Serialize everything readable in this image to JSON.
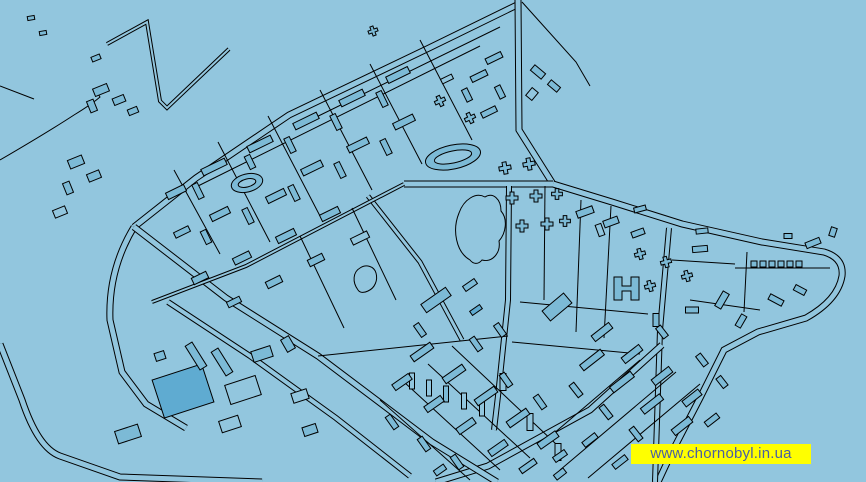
{
  "watermark": {
    "text": "www.chornobyl.in.ua",
    "background_color": "#FFFF00",
    "text_color": "#4A5FA3"
  },
  "map": {
    "colors": {
      "background": "#92C6DE",
      "building": "#7CBAD6",
      "building_dark": "#5FABD1",
      "line": "#000000"
    },
    "roads": [
      {
        "d": "M 517,5 L 429,48 L 289,115 L 196,178 L 134,227",
        "w": 7
      },
      {
        "d": "M 518,0 L 519,130 L 553,184",
        "w": 7
      },
      {
        "d": "M 553,184 L 612,202 L 682,224 L 762,242 L 824,252 Q 844,258 842,276 Q 838,300 806,318 L 758,332 L 724,350 L 700,398 L 672,452 L 658,482",
        "w": 7
      },
      {
        "d": "M 404,184 L 553,184",
        "w": 7
      },
      {
        "d": "M 509,186 L 508,300 L 498,396 L 494,430",
        "w": 6
      },
      {
        "d": "M 669,228 L 660,330 L 655,482",
        "w": 6
      },
      {
        "d": "M 662,345 L 590,410 L 488,466 L 436,482",
        "w": 7
      },
      {
        "d": "M 134,227 Q 108,270 110,320 L 122,372 L 146,404 L 186,428",
        "w": 7
      },
      {
        "d": "M 0,344 L 22,400 Q 38,448 60,456 L 120,477 L 262,482",
        "w": 7
      },
      {
        "d": "M 134,227 L 226,298 L 318,356 L 432,442 L 497,482",
        "w": 7
      },
      {
        "d": "M 168,302 L 250,356 L 336,418 L 410,476",
        "w": 6
      },
      {
        "d": "M 368,196 L 420,262 L 462,340",
        "w": 5
      },
      {
        "d": "M 107,44 L 147,22 L 160,101 L 167,108 L 229,49",
        "w": 4
      },
      {
        "d": "M 404,184 L 246,266 L 152,302",
        "w": 4
      },
      {
        "d": "M 0,160 Q 48,132 74,115 Q 92,104 100,97 L 95,89",
        "w": 1
      },
      {
        "d": "M 0,86 L 34,99",
        "w": 1
      },
      {
        "d": "M 500,27 L 298,126",
        "w": 1
      },
      {
        "d": "M 480,46 L 196,187",
        "w": 1
      },
      {
        "d": "M 420,40 L 472,140",
        "w": 1
      },
      {
        "d": "M 370,64 L 422,164",
        "w": 1
      },
      {
        "d": "M 320,90 L 372,190",
        "w": 1
      },
      {
        "d": "M 268,116 L 320,216",
        "w": 1
      },
      {
        "d": "M 218,142 L 270,242",
        "w": 1
      },
      {
        "d": "M 174,170 L 220,254",
        "w": 1
      },
      {
        "d": "M 352,208 L 396,300",
        "w": 1
      },
      {
        "d": "M 300,236 L 344,328",
        "w": 1
      },
      {
        "d": "M 545,186 L 544,300",
        "w": 1
      },
      {
        "d": "M 581,200 L 576,332",
        "w": 1
      },
      {
        "d": "M 611,206 L 604,338",
        "w": 1
      },
      {
        "d": "M 520,302 L 648,314",
        "w": 1
      },
      {
        "d": "M 512,342 L 640,354",
        "w": 1
      },
      {
        "d": "M 735,268 L 830,268",
        "w": 1
      },
      {
        "d": "M 747,252 L 744,312",
        "w": 1
      },
      {
        "d": "M 672,260 L 735,264",
        "w": 1
      },
      {
        "d": "M 690,300 L 760,310",
        "w": 1
      },
      {
        "d": "M 560,470 L 676,372",
        "w": 1
      },
      {
        "d": "M 588,478 L 700,384",
        "w": 1
      },
      {
        "d": "M 546,440 L 640,360",
        "w": 1
      },
      {
        "d": "M 380,400 L 470,480",
        "w": 1
      },
      {
        "d": "M 404,382 L 500,470",
        "w": 1
      },
      {
        "d": "M 428,364 L 530,458",
        "w": 1
      },
      {
        "d": "M 452,346 L 556,444",
        "w": 1
      },
      {
        "d": "M 318,356 L 508,336",
        "w": 1
      },
      {
        "d": "M 522,2 L 576,62 L 590,86",
        "w": 1
      }
    ],
    "organic": [
      {
        "d": "M 470,260 C 456,252 452,230 459,213 C 464,199 476,192 485,197 C 493,192 501,199 501,211 C 508,219 506,233 499,241 C 501,253 492,263 482,260 C 478,265 473,264 470,260 Z",
        "f": 0
      },
      {
        "d": "M 358,290 C 352,282 353,272 360,268 C 366,264 374,266 376,273 C 378,280 375,288 368,291 C 364,293 360,293 358,290 Z",
        "f": 0
      },
      {
        "d": "M 614,277 l 8,0 0,9 9,0 0,-9 8,0 0,23 -8,0 0,-9 -9,0 0,9 -8,0 z",
        "f": 1
      }
    ],
    "stadiums": [
      {
        "x": 453,
        "y": 157,
        "rx": 28,
        "ry": 12,
        "rx2": 19,
        "ry2": 6,
        "a": -12
      },
      {
        "x": 247,
        "y": 183,
        "rx": 16,
        "ry": 9,
        "rx2": 9,
        "ry2": 4,
        "a": -14
      }
    ],
    "buildings": [
      [
        31,
        18,
        7,
        4,
        -10,
        1
      ],
      [
        43,
        33,
        7,
        4,
        -10,
        1
      ],
      [
        96,
        58,
        9,
        5,
        -22,
        1
      ],
      [
        101,
        90,
        15,
        8,
        -22,
        1
      ],
      [
        119,
        100,
        12,
        7,
        -22,
        1
      ],
      [
        92,
        106,
        7,
        12,
        -22,
        1
      ],
      [
        133,
        111,
        10,
        6,
        -22,
        1
      ],
      [
        494,
        58,
        17,
        6,
        -26,
        1
      ],
      [
        479,
        76,
        17,
        6,
        -26,
        1
      ],
      [
        500,
        92,
        6,
        13,
        -26,
        1
      ],
      [
        467,
        95,
        6,
        13,
        -26,
        1
      ],
      [
        489,
        112,
        16,
        6,
        -26,
        1
      ],
      [
        447,
        79,
        12,
        5,
        -26,
        0
      ],
      [
        398,
        75,
        24,
        7,
        -26,
        1
      ],
      [
        352,
        98,
        26,
        7,
        -26,
        1
      ],
      [
        306,
        121,
        26,
        7,
        -26,
        1
      ],
      [
        260,
        144,
        26,
        7,
        -26,
        1
      ],
      [
        214,
        167,
        26,
        7,
        -26,
        1
      ],
      [
        176,
        192,
        20,
        7,
        -26,
        1
      ],
      [
        382,
        99,
        6,
        16,
        -26,
        1
      ],
      [
        336,
        122,
        6,
        16,
        -26,
        1
      ],
      [
        290,
        145,
        6,
        16,
        -26,
        1
      ],
      [
        250,
        162,
        6,
        14,
        -26,
        1
      ],
      [
        198,
        191,
        6,
        16,
        -26,
        1
      ],
      [
        404,
        122,
        22,
        7,
        -26,
        1
      ],
      [
        358,
        145,
        22,
        7,
        -26,
        1
      ],
      [
        312,
        168,
        22,
        7,
        -26,
        1
      ],
      [
        276,
        196,
        20,
        7,
        -26,
        1
      ],
      [
        220,
        214,
        20,
        7,
        -26,
        1
      ],
      [
        182,
        232,
        16,
        6,
        -26,
        1
      ],
      [
        340,
        170,
        6,
        16,
        -26,
        1
      ],
      [
        294,
        193,
        6,
        16,
        -26,
        1
      ],
      [
        248,
        216,
        6,
        16,
        -26,
        1
      ],
      [
        206,
        237,
        6,
        14,
        -26,
        1
      ],
      [
        386,
        147,
        6,
        16,
        -26,
        1
      ],
      [
        330,
        214,
        20,
        7,
        -26,
        1
      ],
      [
        286,
        236,
        20,
        7,
        -26,
        1
      ],
      [
        242,
        258,
        18,
        7,
        -26,
        1
      ],
      [
        200,
        278,
        16,
        7,
        -26,
        1
      ],
      [
        360,
        238,
        18,
        7,
        -26,
        0
      ],
      [
        316,
        260,
        16,
        7,
        -26,
        1
      ],
      [
        274,
        282,
        16,
        7,
        -26,
        1
      ],
      [
        234,
        302,
        14,
        6,
        -26,
        1
      ],
      [
        76,
        162,
        15,
        9,
        -22,
        1
      ],
      [
        94,
        176,
        13,
        8,
        -22,
        1
      ],
      [
        68,
        188,
        7,
        12,
        -22,
        1
      ],
      [
        60,
        212,
        13,
        8,
        -22,
        0
      ],
      [
        538,
        72,
        14,
        7,
        40,
        1
      ],
      [
        554,
        86,
        12,
        6,
        40,
        1
      ],
      [
        532,
        94,
        8,
        10,
        40,
        0
      ],
      [
        600,
        230,
        6,
        12,
        -20,
        0
      ],
      [
        640,
        209,
        12,
        5,
        -15,
        1
      ],
      [
        702,
        231,
        12,
        5,
        -6,
        1
      ],
      [
        585,
        212,
        17,
        7,
        -20,
        1
      ],
      [
        611,
        222,
        15,
        7,
        -20,
        1
      ],
      [
        638,
        233,
        13,
        6,
        -20,
        1
      ],
      [
        700,
        249,
        15,
        6,
        -5,
        1
      ],
      [
        722,
        300,
        17,
        7,
        -60,
        1
      ],
      [
        741,
        321,
        13,
        6,
        -60,
        1
      ],
      [
        776,
        300,
        15,
        6,
        28,
        1
      ],
      [
        800,
        290,
        12,
        6,
        28,
        1
      ],
      [
        692,
        310,
        13,
        6,
        0,
        1
      ],
      [
        656,
        320,
        6,
        13,
        0,
        1
      ],
      [
        788,
        236,
        8,
        5,
        0,
        1
      ],
      [
        813,
        243,
        15,
        6,
        -22,
        1
      ],
      [
        833,
        232,
        6,
        9,
        18,
        1
      ],
      [
        754,
        264,
        6,
        6,
        0,
        1
      ],
      [
        763,
        264,
        6,
        6,
        0,
        1
      ],
      [
        772,
        264,
        6,
        6,
        0,
        1
      ],
      [
        781,
        264,
        6,
        6,
        0,
        1
      ],
      [
        790,
        264,
        6,
        6,
        0,
        1
      ],
      [
        799,
        264,
        6,
        6,
        0,
        1
      ],
      [
        436,
        300,
        30,
        10,
        -35,
        1
      ],
      [
        557,
        307,
        28,
        13,
        -40,
        1
      ],
      [
        470,
        285,
        14,
        6,
        -35,
        1
      ],
      [
        420,
        330,
        6,
        14,
        -35,
        1
      ],
      [
        476,
        310,
        12,
        5,
        -35,
        2
      ],
      [
        412,
        381,
        5,
        16,
        0,
        0
      ],
      [
        429,
        388,
        5,
        16,
        0,
        0
      ],
      [
        446,
        394,
        5,
        16,
        0,
        1
      ],
      [
        464,
        401,
        5,
        16,
        0,
        0
      ],
      [
        482,
        408,
        5,
        16,
        0,
        0
      ],
      [
        503,
        382,
        6,
        17,
        0,
        0
      ],
      [
        530,
        422,
        6,
        17,
        0,
        0
      ],
      [
        558,
        452,
        6,
        17,
        0,
        0
      ],
      [
        592,
        360,
        26,
        7,
        -38,
        1
      ],
      [
        622,
        382,
        26,
        7,
        -38,
        1
      ],
      [
        652,
        404,
        24,
        7,
        -38,
        1
      ],
      [
        682,
        426,
        22,
        7,
        -38,
        1
      ],
      [
        602,
        332,
        22,
        7,
        -38,
        1
      ],
      [
        632,
        354,
        22,
        7,
        -38,
        1
      ],
      [
        662,
        376,
        22,
        7,
        -38,
        1
      ],
      [
        692,
        398,
        20,
        7,
        -38,
        1
      ],
      [
        712,
        420,
        15,
        6,
        -38,
        1
      ],
      [
        576,
        390,
        6,
        15,
        -38,
        1
      ],
      [
        606,
        412,
        6,
        15,
        -38,
        1
      ],
      [
        636,
        434,
        6,
        15,
        -38,
        1
      ],
      [
        662,
        332,
        6,
        13,
        -38,
        1
      ],
      [
        702,
        360,
        13,
        6,
        52,
        1
      ],
      [
        722,
        382,
        12,
        6,
        52,
        1
      ],
      [
        590,
        440,
        16,
        6,
        -38,
        1
      ],
      [
        620,
        462,
        16,
        6,
        -38,
        1
      ],
      [
        422,
        352,
        24,
        7,
        -35,
        1
      ],
      [
        454,
        374,
        24,
        7,
        -35,
        1
      ],
      [
        486,
        396,
        24,
        7,
        -35,
        1
      ],
      [
        518,
        418,
        24,
        7,
        -35,
        1
      ],
      [
        548,
        440,
        22,
        7,
        -35,
        1
      ],
      [
        402,
        382,
        20,
        7,
        -35,
        1
      ],
      [
        434,
        404,
        20,
        7,
        -35,
        1
      ],
      [
        466,
        426,
        20,
        7,
        -35,
        1
      ],
      [
        498,
        448,
        20,
        7,
        -35,
        1
      ],
      [
        528,
        466,
        18,
        6,
        -35,
        1
      ],
      [
        392,
        422,
        6,
        15,
        -35,
        1
      ],
      [
        424,
        444,
        6,
        15,
        -35,
        1
      ],
      [
        457,
        462,
        6,
        15,
        -35,
        1
      ],
      [
        506,
        380,
        6,
        15,
        -35,
        1
      ],
      [
        540,
        402,
        6,
        15,
        -35,
        1
      ],
      [
        476,
        344,
        6,
        15,
        -35,
        1
      ],
      [
        560,
        456,
        14,
        6,
        -35,
        1
      ],
      [
        500,
        330,
        14,
        6,
        55,
        1
      ],
      [
        183,
        391,
        52,
        40,
        -18,
        2
      ],
      [
        243,
        390,
        32,
        20,
        -18,
        0
      ],
      [
        230,
        424,
        20,
        12,
        -18,
        0
      ],
      [
        128,
        434,
        24,
        13,
        -18,
        1
      ],
      [
        262,
        354,
        20,
        11,
        -18,
        1
      ],
      [
        288,
        344,
        14,
        9,
        60,
        1
      ],
      [
        196,
        356,
        28,
        8,
        58,
        1
      ],
      [
        222,
        362,
        28,
        8,
        58,
        1
      ],
      [
        160,
        356,
        10,
        8,
        -18,
        1
      ],
      [
        300,
        396,
        16,
        10,
        -18,
        0
      ],
      [
        310,
        430,
        14,
        9,
        -18,
        1
      ],
      [
        560,
        474,
        12,
        6,
        -38,
        1
      ],
      [
        440,
        470,
        12,
        6,
        -35,
        1
      ]
    ],
    "crosses": [
      [
        373,
        31,
        1.6,
        -20
      ],
      [
        440,
        101,
        1.8,
        -25
      ],
      [
        470,
        118,
        1.8,
        -25
      ],
      [
        505,
        168,
        2,
        -10
      ],
      [
        529,
        164,
        2,
        -10
      ],
      [
        512,
        198,
        2,
        0
      ],
      [
        536,
        196,
        2,
        0
      ],
      [
        557,
        194,
        1.8,
        0
      ],
      [
        522,
        226,
        2,
        0
      ],
      [
        547,
        224,
        2,
        0
      ],
      [
        565,
        221,
        1.8,
        0
      ],
      [
        640,
        254,
        1.8,
        -15
      ],
      [
        666,
        262,
        1.8,
        -15
      ],
      [
        687,
        276,
        1.8,
        -15
      ],
      [
        650,
        286,
        1.8,
        -15
      ]
    ]
  }
}
